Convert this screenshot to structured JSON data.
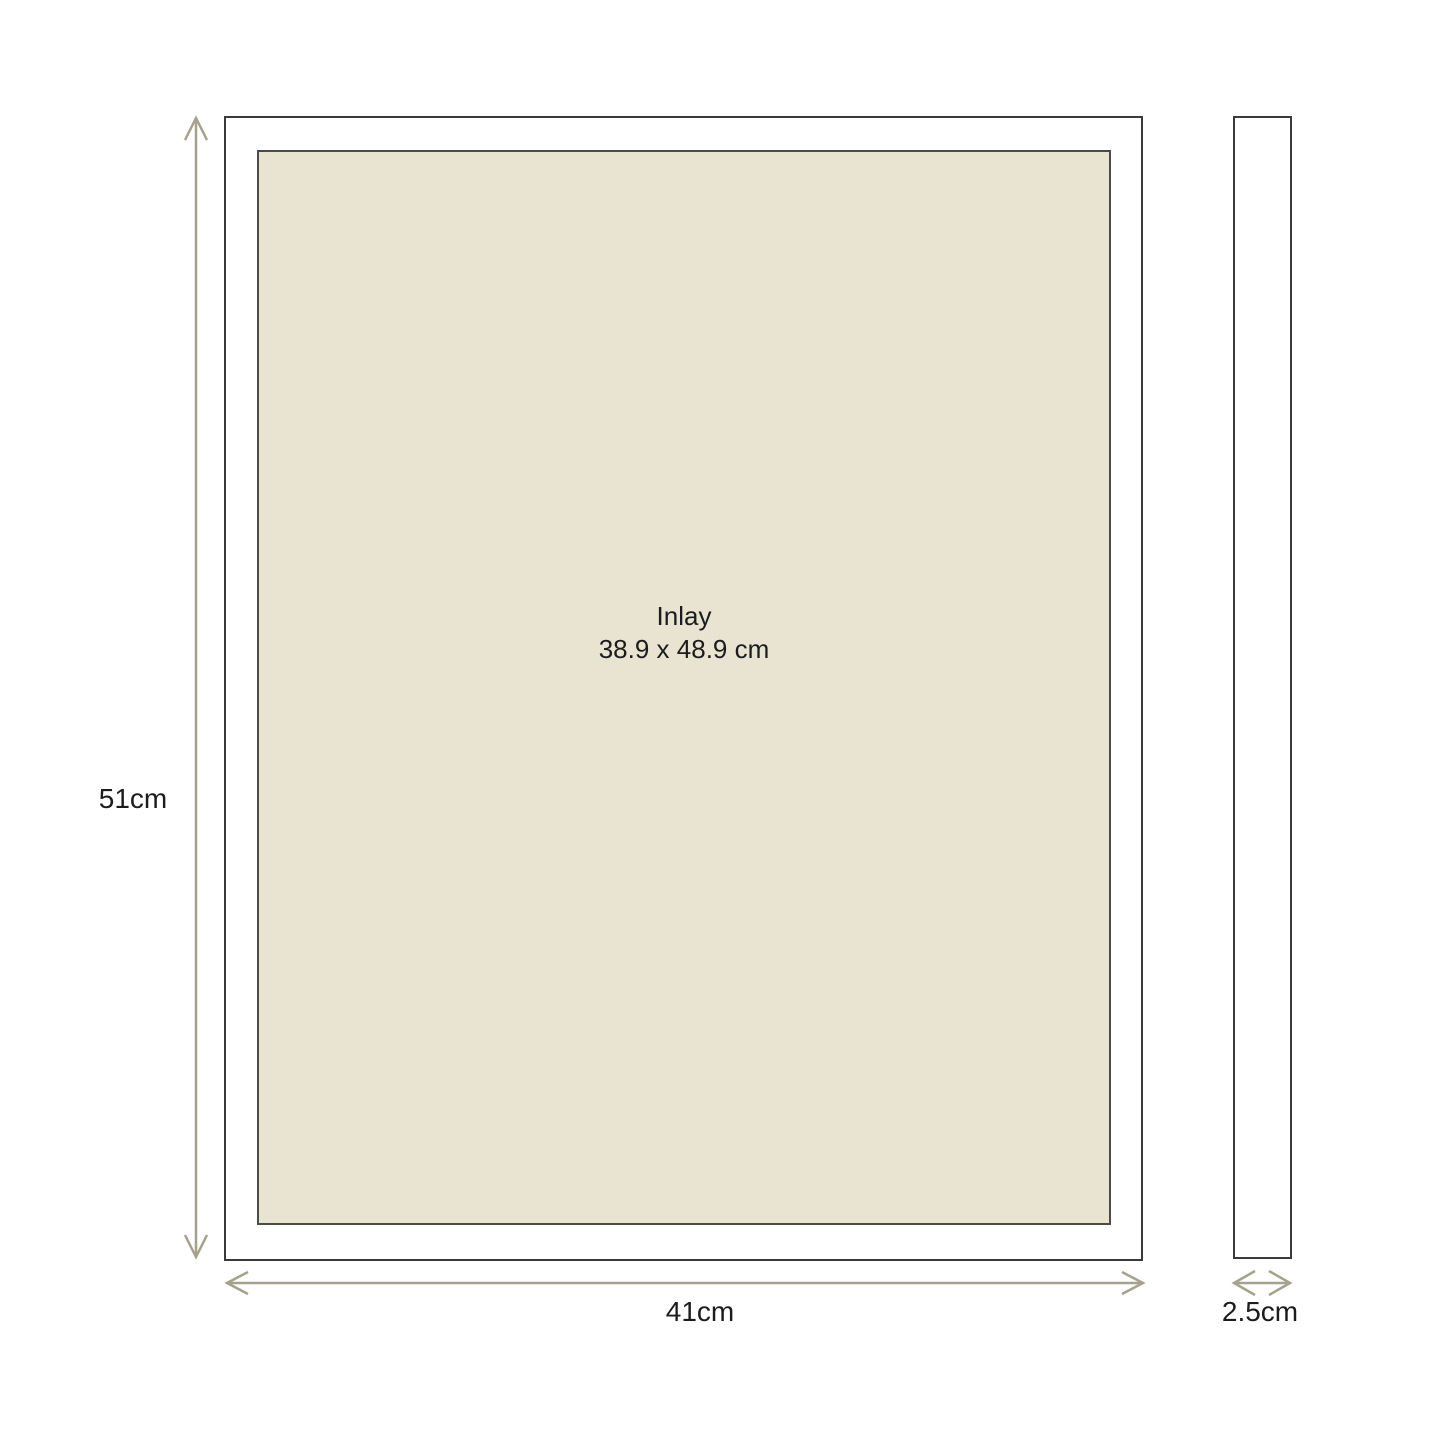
{
  "diagram": {
    "front_view": {
      "inlay_label": "Inlay",
      "inlay_size": "38.9 x 48.9 cm",
      "height_label": "51cm",
      "width_label": "41cm"
    },
    "side_view": {
      "depth_label": "2.5cm"
    },
    "colors": {
      "background": "#ffffff",
      "inlay_fill": "#e9e3d2",
      "frame_border": "#3a3a38",
      "inlay_border": "#4c4b44",
      "dimension_arrow": "#a5a28c",
      "label_text": "#1c1c1c"
    }
  }
}
